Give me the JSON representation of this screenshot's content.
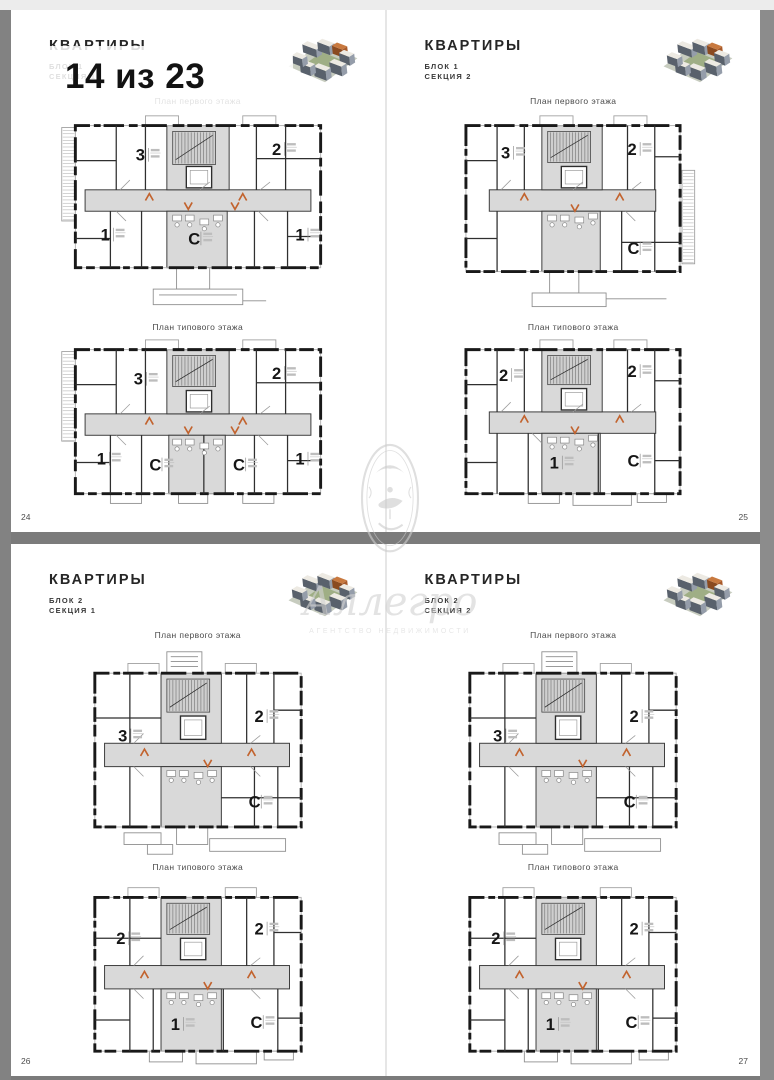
{
  "viewer": {
    "overlay_page_indicator": "14 из 23"
  },
  "watermark": {
    "name": "Аллегро",
    "subtitle": "АГЕНТСТВО НЕДВИЖИМОСТИ"
  },
  "colors": {
    "corridor_fill": "#d9d9d9",
    "wall": "#191919",
    "entry_arrow": "#c2632e",
    "gap_band": "#7b7b7b",
    "page_background": "#ffffff"
  },
  "pages": [
    {
      "page_number": "24",
      "title": "КВАРТИРЫ",
      "block": "БЛОК 1",
      "section": "СЕКЦИЯ 1",
      "plans": [
        {
          "title": "План первого этажа",
          "apartments": [
            "3",
            "2",
            "1",
            "С",
            "1"
          ]
        },
        {
          "title": "План типового этажа",
          "apartments": [
            "3",
            "2",
            "1",
            "С",
            "С",
            "1"
          ]
        }
      ]
    },
    {
      "page_number": "25",
      "title": "КВАРТИРЫ",
      "block": "БЛОК 1",
      "section": "СЕКЦИЯ 2",
      "plans": [
        {
          "title": "План первого этажа",
          "apartments": [
            "3",
            "2",
            "С"
          ]
        },
        {
          "title": "План типового этажа",
          "apartments": [
            "2",
            "2",
            "1",
            "С"
          ]
        }
      ]
    },
    {
      "page_number": "26",
      "title": "КВАРТИРЫ",
      "block": "БЛОК 2",
      "section": "СЕКЦИЯ 1",
      "plans": [
        {
          "title": "План первого этажа",
          "apartments": [
            "3",
            "2",
            "С"
          ]
        },
        {
          "title": "План типового этажа",
          "apartments": [
            "2",
            "2",
            "1",
            "С"
          ]
        }
      ]
    },
    {
      "page_number": "27",
      "title": "КВАРТИРЫ",
      "block": "БЛОК 2",
      "section": "СЕКЦИЯ 2",
      "plans": [
        {
          "title": "План первого этажа",
          "apartments": [
            "3",
            "2",
            "С"
          ]
        },
        {
          "title": "План типового этажа",
          "apartments": [
            "2",
            "2",
            "1",
            "С"
          ]
        }
      ]
    }
  ]
}
